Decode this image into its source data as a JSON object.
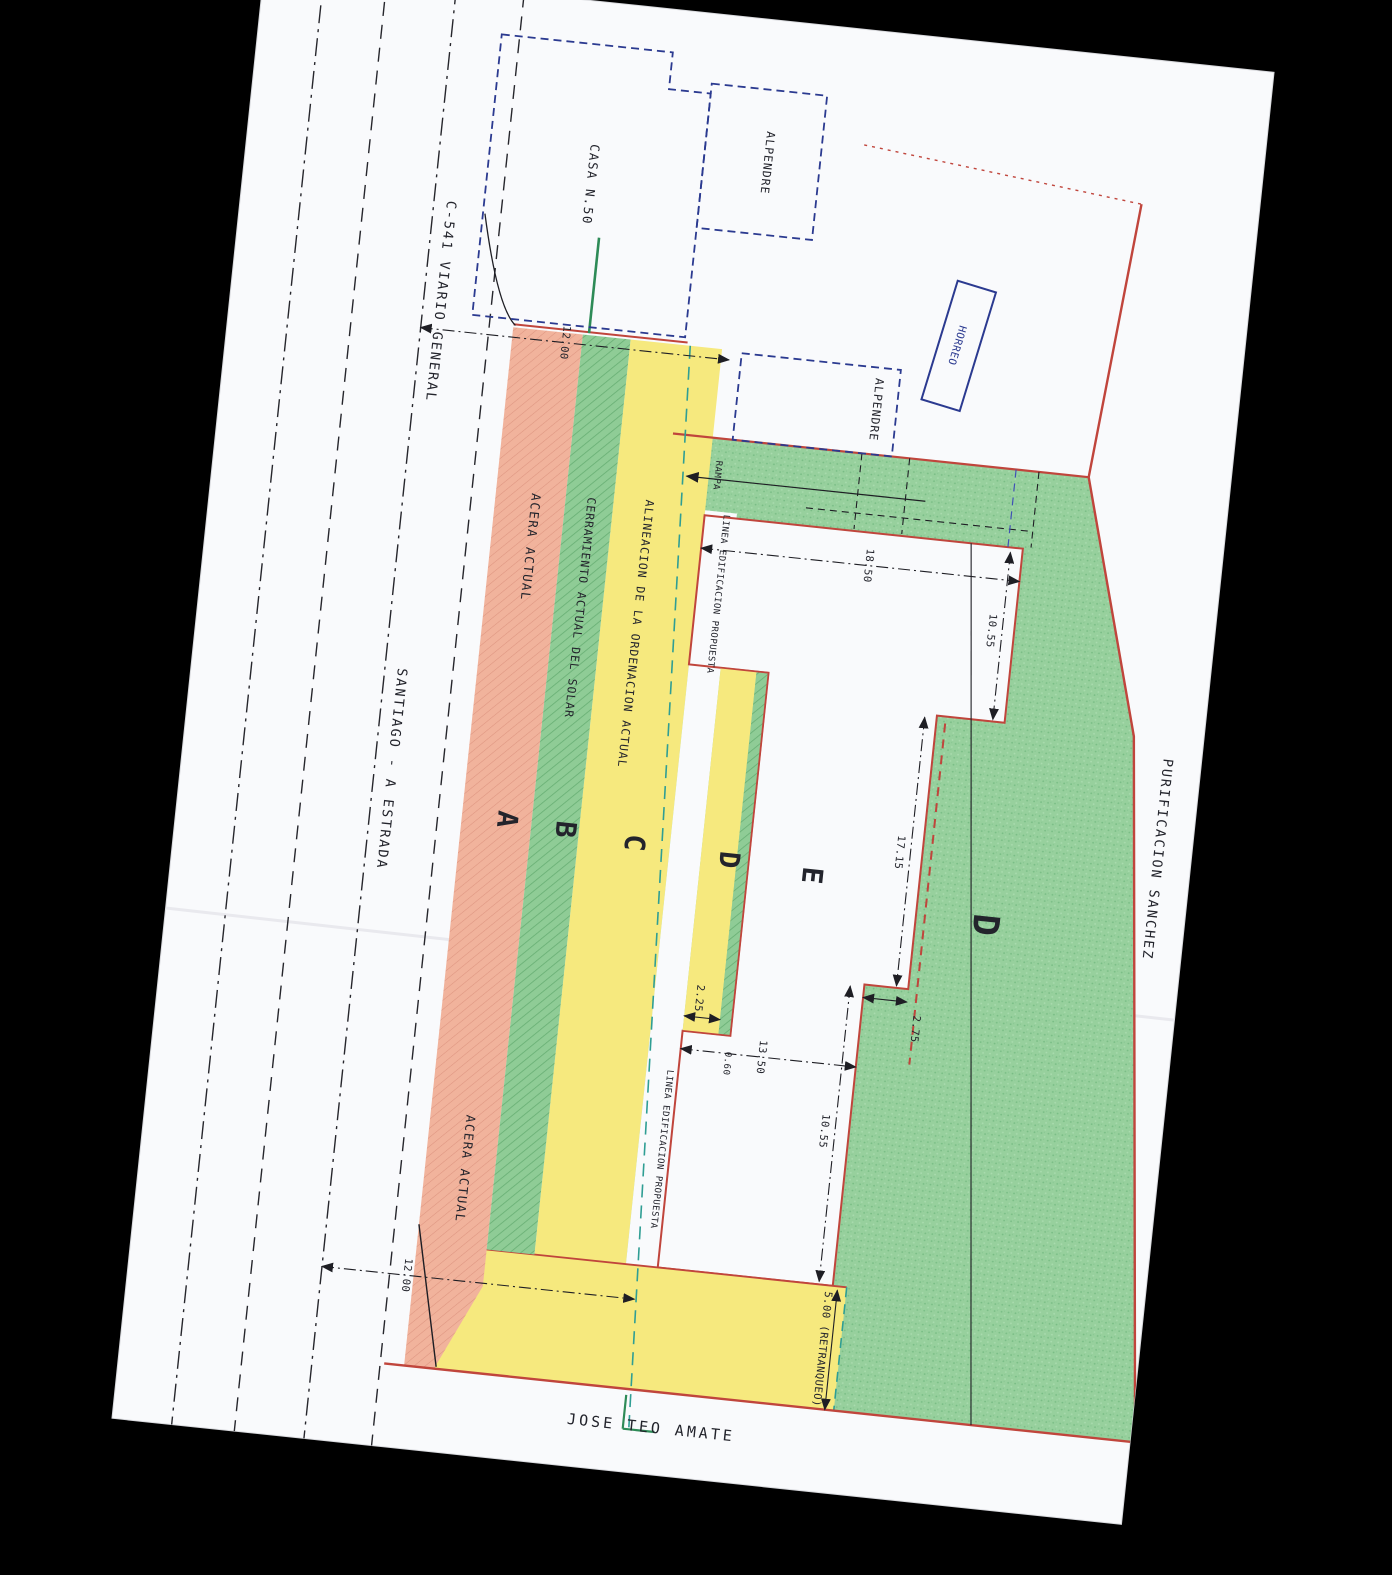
{
  "buildings": {
    "casa": "CASA N.50",
    "alpendre_top": "ALPENDRE",
    "alpendre_mid": "ALPENDRE",
    "horreo": "HORREO"
  },
  "road": {
    "name_line1": "C-541  VIARIO GENERAL",
    "name_line2": "SANTIAGO - A ESTRADA"
  },
  "bands": {
    "sidewalk_label_top": "ACERA ACTUAL",
    "sidewalk_label_bottom": "ACERA ACTUAL",
    "fence_label": "CERRAMIENTO ACTUAL DEL SOLAR",
    "alignment_label": "ALINEACION DE LA ORDENACION ACTUAL"
  },
  "proposed": {
    "line_label_upper": "LINEA EDIFICACION PROPUESTA",
    "line_label_lower": "LINEA EDIFICACION PROPUESTA",
    "ramp_label": "RAMPA"
  },
  "neighbors": {
    "east": "PURIFICACION SANCHEZ",
    "south": "JOSE TEO AMATE"
  },
  "zones": {
    "a": "A",
    "b": "B",
    "c": "C",
    "d_small": "D",
    "e": "E",
    "d_large": "D"
  },
  "dimensions": {
    "road_top": "12.00",
    "road_bottom": "12.00",
    "top_edge": "18.50",
    "right_upper": "10.55",
    "right_mid": "17.15",
    "notch": "2.75",
    "right_lower": "10.55",
    "width_mid": "13.50",
    "step_a": "2.25",
    "step_b": "0.60",
    "setback": "5.00 (RETRANQUEO)"
  },
  "colors": {
    "paper": "#f9fafc",
    "zone_green": "#97d09d",
    "zone_pink": "#f1b39c",
    "zone_yellow": "#f6e97e",
    "boundary_red": "#c0453c",
    "building_blue": "#2b3a90",
    "alignment_teal": "#2f9e94"
  }
}
